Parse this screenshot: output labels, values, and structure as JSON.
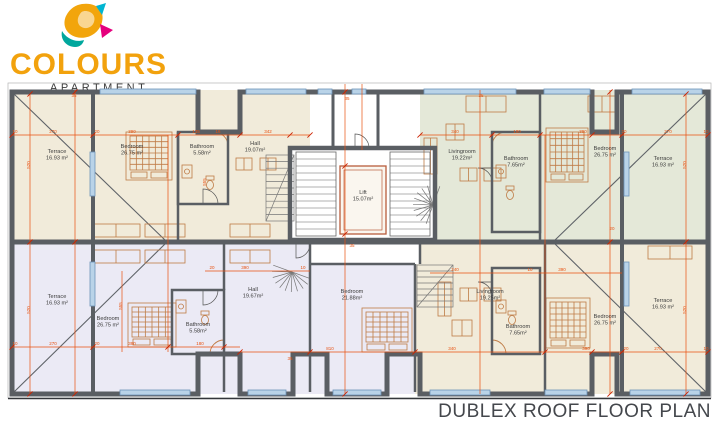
{
  "logo": {
    "title": "COLOURS",
    "subtitle": "APARTMENT"
  },
  "plan_title": "DUBLEX ROOF FLOOR PLAN",
  "colors": {
    "wall": "#5a5e63",
    "dim_line": "#e8500f",
    "cream": "#f1ebda",
    "sage": "#e4e8d8",
    "lavender": "#ebeaf5",
    "window": "#b9d3e8",
    "window_border": "#6d93b8",
    "furniture": "#bf7b45",
    "label_color": "#3b3b3b",
    "logo_orange": "#f2a20d",
    "logo_teal": "#00a79d",
    "logo_magenta": "#e5007d",
    "logo_cyan": "#00b5d1",
    "title_color": "#44474c"
  },
  "rooms": [
    {
      "name": "terrace-top-left",
      "label": "Terrace",
      "area": "16.93 m²",
      "x": 57,
      "y": 153
    },
    {
      "name": "bedroom-top-left",
      "label": "Bedroom",
      "area": "26.75 m²",
      "x": 132,
      "y": 148
    },
    {
      "name": "bathroom-top-left",
      "label": "Bathroom",
      "area": "5.58m²",
      "x": 202,
      "y": 148
    },
    {
      "name": "hall-top-left",
      "label": "Hall",
      "area": "19.07m²",
      "x": 255,
      "y": 145
    },
    {
      "name": "lift",
      "label": "Lift",
      "area": "15.07m²",
      "x": 363,
      "y": 194
    },
    {
      "name": "livingroom-top-right",
      "label": "Livingroom",
      "area": "19.22m²",
      "x": 462,
      "y": 153
    },
    {
      "name": "bathroom-top-right",
      "label": "Bathroom",
      "area": "7.65m²",
      "x": 516,
      "y": 160
    },
    {
      "name": "bedroom-top-right",
      "label": "Bedroom",
      "area": "26.75 m²",
      "x": 605,
      "y": 150
    },
    {
      "name": "terrace-top-right",
      "label": "Terrace",
      "area": "16.93 m²",
      "x": 663,
      "y": 160
    },
    {
      "name": "terrace-bottom-left",
      "label": "Terrace",
      "area": "16.93 m²",
      "x": 57,
      "y": 298
    },
    {
      "name": "bedroom-bottom-left",
      "label": "Bedroom",
      "area": "26.75 m²",
      "x": 108,
      "y": 320
    },
    {
      "name": "bathroom-bottom-left",
      "label": "Bathroom",
      "area": "5.58m²",
      "x": 198,
      "y": 326
    },
    {
      "name": "hall-bottom-left",
      "label": "Hall",
      "area": "19.67m²",
      "x": 253,
      "y": 291
    },
    {
      "name": "bedroom-bottom-center",
      "label": "Bedroom",
      "area": "21.88m²",
      "x": 352,
      "y": 293
    },
    {
      "name": "livingroom-bottom-right",
      "label": "Livingroom",
      "area": "19.25m²",
      "x": 490,
      "y": 293
    },
    {
      "name": "bathroom-bottom-right",
      "label": "Bathroom",
      "area": "7.65m²",
      "x": 518,
      "y": 328
    },
    {
      "name": "bedroom-bottom-right",
      "label": "Bedroom",
      "area": "26.75 m²",
      "x": 605,
      "y": 318
    },
    {
      "name": "terrace-bottom-right",
      "label": "Terrace",
      "area": "16.93 m²",
      "x": 663,
      "y": 302
    }
  ],
  "dimensions": [
    {
      "v": "10",
      "x": 15,
      "y": 133
    },
    {
      "v": "270",
      "x": 53,
      "y": 133
    },
    {
      "v": "20",
      "x": 97,
      "y": 133
    },
    {
      "v": "390",
      "x": 132,
      "y": 133
    },
    {
      "v": "135",
      "x": 196,
      "y": 133
    },
    {
      "v": "16",
      "x": 218,
      "y": 133
    },
    {
      "v": "342",
      "x": 268,
      "y": 133
    },
    {
      "v": "340",
      "x": 455,
      "y": 133
    },
    {
      "v": "180",
      "x": 517,
      "y": 133
    },
    {
      "v": "390",
      "x": 583,
      "y": 133
    },
    {
      "v": "20",
      "x": 624,
      "y": 133
    },
    {
      "v": "270",
      "x": 668,
      "y": 133
    },
    {
      "v": "10",
      "x": 706,
      "y": 133
    },
    {
      "v": "20",
      "x": 212,
      "y": 269
    },
    {
      "v": "390",
      "x": 245,
      "y": 269
    },
    {
      "v": "10",
      "x": 303,
      "y": 269
    },
    {
      "v": "240",
      "x": 455,
      "y": 271
    },
    {
      "v": "10",
      "x": 530,
      "y": 271
    },
    {
      "v": "390",
      "x": 562,
      "y": 271
    },
    {
      "v": "10",
      "x": 15,
      "y": 345
    },
    {
      "v": "270",
      "x": 53,
      "y": 345
    },
    {
      "v": "20",
      "x": 97,
      "y": 345
    },
    {
      "v": "390",
      "x": 132,
      "y": 345
    },
    {
      "v": "180",
      "x": 200,
      "y": 345
    },
    {
      "v": "810",
      "x": 330,
      "y": 350
    },
    {
      "v": "340",
      "x": 452,
      "y": 350
    },
    {
      "v": "390",
      "x": 586,
      "y": 350
    },
    {
      "v": "20",
      "x": 626,
      "y": 350
    },
    {
      "v": "270",
      "x": 658,
      "y": 350
    },
    {
      "v": "10",
      "x": 706,
      "y": 350
    },
    {
      "v": "520",
      "x": 30,
      "y": 165,
      "rot": -90
    },
    {
      "v": "520",
      "x": 30,
      "y": 310,
      "rot": -90
    },
    {
      "v": "555",
      "x": 122,
      "y": 306,
      "rot": -90
    },
    {
      "v": "555",
      "x": 206,
      "y": 182,
      "rot": -90
    },
    {
      "v": "520",
      "x": 686,
      "y": 165,
      "rot": -90
    },
    {
      "v": "520",
      "x": 686,
      "y": 310,
      "rot": -90
    },
    {
      "v": "35",
      "x": 74,
      "y": 97
    },
    {
      "v": "35",
      "x": 347,
      "y": 100
    },
    {
      "v": "35",
      "x": 481,
      "y": 97
    },
    {
      "v": "35",
      "x": 352,
      "y": 247
    },
    {
      "v": "20",
      "x": 612,
      "y": 230
    },
    {
      "v": "35",
      "x": 290,
      "y": 360
    }
  ]
}
